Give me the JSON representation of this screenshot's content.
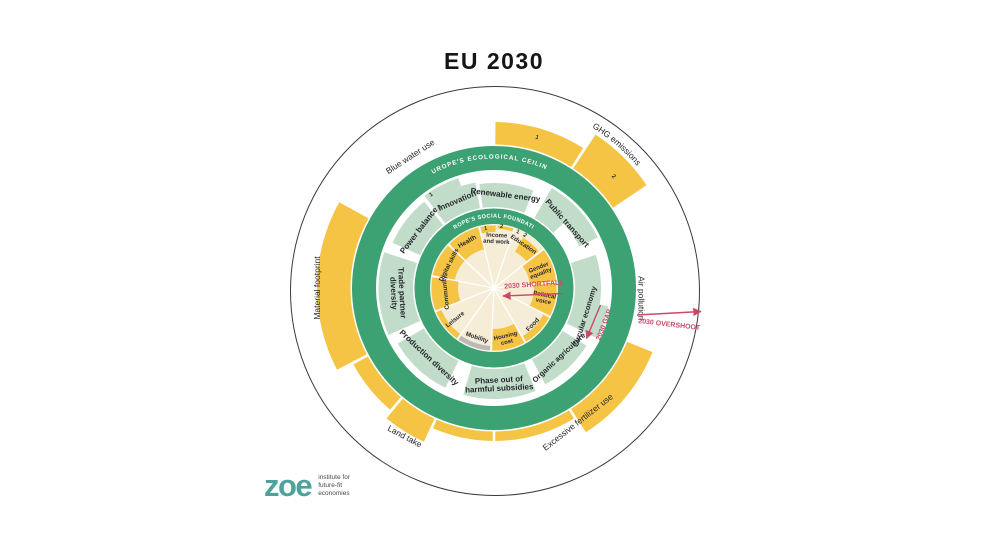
{
  "title": "EU 2030",
  "logo": {
    "wordmark": "zoe",
    "tagline": [
      "institute for",
      "future-fit",
      "economies"
    ]
  },
  "colors": {
    "green": "#3da273",
    "pale": "#c1dcc9",
    "yellow": "#f6c445",
    "cream": "#f5edd6",
    "grey": "#b9b9b9",
    "red": "#cc4868",
    "ink": "#26282b",
    "ring_text": "#ffffff",
    "outline": "#3a3a3a",
    "teal": "#4ea29c",
    "tagline_grey": "#4a4a4a"
  },
  "chart_data": {
    "type": "radial-doughnut-compass",
    "title": "EU 2030",
    "center": {
      "x": 494,
      "y": 288
    },
    "outer_circle": {
      "cx": 495,
      "cy": 291,
      "r": 204.5
    },
    "hub": {
      "r": 63.5
    },
    "spoke_angles": [
      313.6,
      346.4,
      19.1,
      51.8,
      84.5,
      117.3,
      150,
      182.7,
      215.5,
      248.2,
      280.9
    ],
    "green_rings": [
      {
        "name": "ecological-ceiling-ring",
        "r": 130,
        "width": 24
      },
      {
        "name": "social-foundation-ring",
        "r": 71.75,
        "width": 15.5
      }
    ],
    "ring_titles": [
      {
        "name": "ecological-ceiling-title",
        "text": "EUROPE'S ECOLOGICAL CEILING",
        "r": 129.5,
        "a0": -28,
        "a1": 24,
        "size": 6.2,
        "spacing": 1
      },
      {
        "name": "social-foundation-title",
        "text": "EUROPE'S SOCIAL FOUNDATION",
        "r": 70.5,
        "a0": -33,
        "a1": 33,
        "size": 5.6,
        "spacing": 0.4
      }
    ],
    "social_segments": [
      {
        "name": "health",
        "shortfall": 0.85,
        "fills": [
          {
            "a0": 314.6,
            "a1": 345.4,
            "r0": 40,
            "r1": 62.5,
            "color": "yellow"
          }
        ],
        "label": {
          "text": "Health",
          "angle": 330,
          "r": 54,
          "rot": -30,
          "size": 6.5
        }
      },
      {
        "name": "income-and-work",
        "shortfall": [
          0.2,
          0.1
        ],
        "fills": [
          {
            "a0": 347.4,
            "a1": 1.5,
            "r0": 56,
            "r1": 62.5,
            "color": "yellow"
          },
          {
            "a0": 3.5,
            "a1": 18,
            "r0": 59.5,
            "r1": 62.5,
            "color": "yellow"
          }
        ],
        "label": {
          "lines": [
            "Income",
            "and work"
          ],
          "angle": 3,
          "r": 50,
          "rot": 3,
          "size": 6
        }
      },
      {
        "name": "education",
        "shortfall": 0.8,
        "fills": [
          {
            "a0": 30,
            "a1": 50.5,
            "r0": 42,
            "r1": 58,
            "color": "yellow"
          }
        ],
        "label": {
          "text": "Education",
          "angle": 34,
          "r": 53,
          "rot": 34,
          "size": 6.2
        }
      },
      {
        "name": "gender-equality",
        "shortfall": 1.0,
        "fills": [
          {
            "a0": 52.8,
            "a1": 83.5,
            "r0": 36,
            "r1": 62.5,
            "color": "yellow"
          }
        ],
        "label": {
          "lines": [
            "Gender",
            "equality"
          ],
          "angle": 68.5,
          "r": 49,
          "rot": -21.5,
          "size": 6
        }
      },
      {
        "name": "political-voice",
        "shortfall": 0.85,
        "fills": [
          {
            "a0": 85.5,
            "a1": 116.3,
            "r0": 40,
            "r1": 62.5,
            "color": "yellow"
          }
        ],
        "label": {
          "lines": [
            "Political",
            "voice"
          ],
          "angle": 101,
          "r": 51,
          "rot": 11,
          "size": 6
        }
      },
      {
        "name": "food",
        "shortfall": 0.25,
        "fills": [
          {
            "a0": 118.3,
            "a1": 149,
            "r0": 56,
            "r1": 62.5,
            "color": "yellow"
          }
        ],
        "label": {
          "text": "Food",
          "angle": 133.5,
          "r": 53,
          "rot": -46.5,
          "size": 6.5
        }
      },
      {
        "name": "housing-cost",
        "shortfall": 0.8,
        "fills": [
          {
            "a0": 151,
            "a1": 181.7,
            "r0": 41,
            "r1": 62.5,
            "color": "yellow"
          }
        ],
        "label": {
          "lines": [
            "Housing",
            "cost"
          ],
          "angle": 166.5,
          "r": 52,
          "rot": -13.5,
          "size": 6
        }
      },
      {
        "name": "mobility",
        "shortfall": null,
        "fills": [
          {
            "a0": 183.7,
            "a1": 214.5,
            "r0": 58,
            "r1": 62.5,
            "color": "grey"
          }
        ],
        "label": {
          "text": "Mobility",
          "angle": 199,
          "r": 52,
          "rot": 19,
          "size": 6.2
        }
      },
      {
        "name": "leisure",
        "shortfall": 0.2,
        "fills": [
          {
            "a0": 216.5,
            "a1": 247.2,
            "r0": 57,
            "r1": 62.5,
            "color": "yellow"
          }
        ],
        "label": {
          "text": "Leisure",
          "angle": 231.5,
          "r": 50,
          "rot": -38.5,
          "size": 6.2
        }
      },
      {
        "name": "community",
        "shortfall": 1.0,
        "fills": [
          {
            "a0": 249.2,
            "a1": 279.9,
            "r0": 36,
            "r1": 62.5,
            "color": "yellow"
          }
        ],
        "label": {
          "text": "Community",
          "angle": 264.5,
          "r": 49,
          "rot": -95.5,
          "size": 6.2
        }
      },
      {
        "name": "digital-skills",
        "shortfall": 0.85,
        "fills": [
          {
            "a0": 281.9,
            "a1": 312.6,
            "r0": 40,
            "r1": 62.5,
            "color": "yellow"
          }
        ],
        "label": {
          "text": "Digital skills",
          "angle": 297,
          "r": 51,
          "rot": -63,
          "size": 6.2
        }
      }
    ],
    "policy_segments": [
      {
        "name": "innovation",
        "progress": 0.75,
        "arcs": [
          {
            "a0": 323,
            "a1": 350,
            "r0": 81,
            "r1": 107
          },
          {
            "a0": 323,
            "a1": 342,
            "r0": 107,
            "r1": 115.5
          }
        ],
        "label": {
          "text": "Innovation",
          "angle": 337,
          "r": 95,
          "rot": -23,
          "size": 8
        }
      },
      {
        "name": "renewable-energy",
        "progress": 0.7,
        "arcs": [
          {
            "a0": 352,
            "a1": 22,
            "r0": 81,
            "r1": 105
          }
        ],
        "label": {
          "text": "Renewable energy",
          "angle": 7,
          "r": 94,
          "rot": 7,
          "size": 8
        }
      },
      {
        "name": "public-transport",
        "progress": 0.6,
        "arcs": [
          {
            "a0": 30,
            "a1": 47,
            "r0": 81,
            "r1": 115.5
          },
          {
            "a0": 47,
            "a1": 64,
            "r0": 95,
            "r1": 115.5
          }
        ],
        "label": {
          "text": "Public transport",
          "angle": 48.5,
          "r": 98,
          "rot": 48.5,
          "size": 8
        }
      },
      {
        "name": "circular-economy",
        "progress": 0.75,
        "arcs": [
          {
            "a0": 72,
            "a1": 116,
            "r0": 81,
            "r1": 107
          },
          {
            "a0": 99,
            "a1": 116,
            "r0": 107,
            "r1": 115.5
          }
        ],
        "label": {
          "text": "Circular economy",
          "angle": 107.5,
          "r": 95,
          "rot": -72.5,
          "size": 7.5
        }
      },
      {
        "name": "organic-agriculture",
        "progress": 0.8,
        "arcs": [
          {
            "a0": 122,
            "a1": 152,
            "r0": 81,
            "r1": 109
          }
        ],
        "label": {
          "text": "Organic agriculture",
          "angle": 137,
          "r": 95,
          "rot": -43,
          "size": 7.5
        }
      },
      {
        "name": "phase-out-of-harmful-subsidies",
        "progress": 0.85,
        "arcs": [
          {
            "a0": 158,
            "a1": 196,
            "r0": 81,
            "r1": 111
          }
        ],
        "label": {
          "lines": [
            "Phase out of",
            "harmful subsidies"
          ],
          "angle": 177,
          "r": 96,
          "rot": -3,
          "size": 8
        }
      },
      {
        "name": "production-diversity",
        "progress": 0.85,
        "arcs": [
          {
            "a0": 206,
            "a1": 240,
            "r0": 81,
            "r1": 111
          }
        ],
        "label": {
          "text": "Production diversity",
          "angle": 223,
          "r": 95,
          "rot": 43,
          "size": 8
        }
      },
      {
        "name": "trade-partner-diversity",
        "progress": 1.0,
        "arcs": [
          {
            "a0": 246,
            "a1": 288,
            "r0": 81,
            "r1": 115.5
          }
        ],
        "label": {
          "lines": [
            "Trade partner",
            "diversity"
          ],
          "angle": 267,
          "r": 96,
          "rot": 87,
          "size": 8
        }
      },
      {
        "name": "power-balance",
        "progress": 0.85,
        "arcs": [
          {
            "a0": 294,
            "a1": 321,
            "r0": 81,
            "r1": 111
          }
        ],
        "label": {
          "text": "Power balance",
          "angle": 307.5,
          "r": 95,
          "rot": -52.5,
          "size": 8
        }
      }
    ],
    "overshoot_arcs": [
      {
        "name": "ghg-emissions-1",
        "value": 0.3,
        "a0": 0.5,
        "a1": 32.5,
        "r0": 143.5,
        "r1": 166
      },
      {
        "name": "ghg-emissions-2",
        "value": 0.6,
        "a0": 33.5,
        "a1": 56,
        "r0": 143.5,
        "r1": 184
      },
      {
        "name": "excessive-fertilizer-use",
        "value": 0.45,
        "a0": 112,
        "a1": 147.5,
        "r0": 143.5,
        "r1": 171
      },
      {
        "name": "bottom-arc-a",
        "value": 0.15,
        "a0": 148.5,
        "a1": 179.5,
        "r0": 143.5,
        "r1": 153
      },
      {
        "name": "bottom-arc-b",
        "value": 0.15,
        "a0": 180.5,
        "a1": 203.5,
        "r0": 143.5,
        "r1": 153
      },
      {
        "name": "land-take",
        "value": 0.4,
        "a0": 204.5,
        "a1": 219.5,
        "r0": 143.5,
        "r1": 169
      },
      {
        "name": "left-arc",
        "value": 0.27,
        "a0": 220.5,
        "a1": 241.5,
        "r0": 143.5,
        "r1": 160
      },
      {
        "name": "material-footprint",
        "value": 0.55,
        "a0": 242.5,
        "a1": 299,
        "r0": 143.5,
        "r1": 177
      }
    ],
    "digits": [
      {
        "text": "1",
        "angle": 16,
        "r": 155
      },
      {
        "text": "2",
        "angle": 47,
        "r": 162
      },
      {
        "text": "1",
        "angle": 326,
        "r": 111
      },
      {
        "text": "2",
        "angle": 326,
        "r": 96
      },
      {
        "text": "1",
        "angle": 352,
        "r": 58.5
      },
      {
        "text": "2",
        "angle": 7,
        "r": 60.5
      },
      {
        "text": "1",
        "angle": 23,
        "r": 59.5
      },
      {
        "text": "2",
        "angle": 30.5,
        "r": 59.5
      }
    ],
    "curved_labels": [
      {
        "name": "ghg-emissions-label",
        "text": "GHG emissions",
        "r": 188,
        "a0": 25,
        "a1": 56,
        "size": 8.5
      }
    ],
    "outer_labels": [
      {
        "name": "air-pollution-label",
        "text": "Air pollution",
        "angle": 94,
        "r": 148,
        "rot": 90,
        "size": 8.5
      },
      {
        "name": "excessive-fertilizer-use-label",
        "text": "Excessive fertilizer use",
        "angle": 148,
        "r": 158,
        "rot": -38,
        "size": 8.5
      },
      {
        "name": "land-take-label",
        "text": "Land take",
        "angle": 211,
        "r": 173,
        "rot": 28,
        "size": 8.5
      },
      {
        "name": "material-footprint-label",
        "text": "Material footprint",
        "angle": 270,
        "r": 177,
        "rot": -90,
        "size": 8.5
      },
      {
        "name": "blue-water-use-label",
        "text": "Blue water use",
        "angle": 327.5,
        "r": 156,
        "rot": -33,
        "size": 8.5
      }
    ],
    "annotations": [
      {
        "name": "shortfall-arrow",
        "type": "arrow",
        "x1": 563,
        "y1": 293.5,
        "x2": 503,
        "y2": 296
      },
      {
        "name": "shortfall-label",
        "type": "text",
        "text": "2030 SHORTFALL",
        "x": 534,
        "y": 286.5,
        "rot": -4,
        "size": 7
      },
      {
        "name": "gap-arrow",
        "type": "arrow",
        "x1": 600.5,
        "y1": 305,
        "x2": 586.5,
        "y2": 338.5
      },
      {
        "name": "gap-label",
        "type": "text",
        "text": "2030 GAP",
        "x": 606,
        "y": 325.5,
        "rot": -69,
        "size": 7
      },
      {
        "name": "overshoot-arrow",
        "type": "arrow",
        "x1": 637,
        "y1": 315,
        "x2": 701,
        "y2": 311.5
      },
      {
        "name": "overshoot-label",
        "type": "text",
        "text": "2030 OVERSHOOT",
        "x": 669,
        "y": 326.5,
        "rot": 6.5,
        "size": 7
      }
    ]
  }
}
